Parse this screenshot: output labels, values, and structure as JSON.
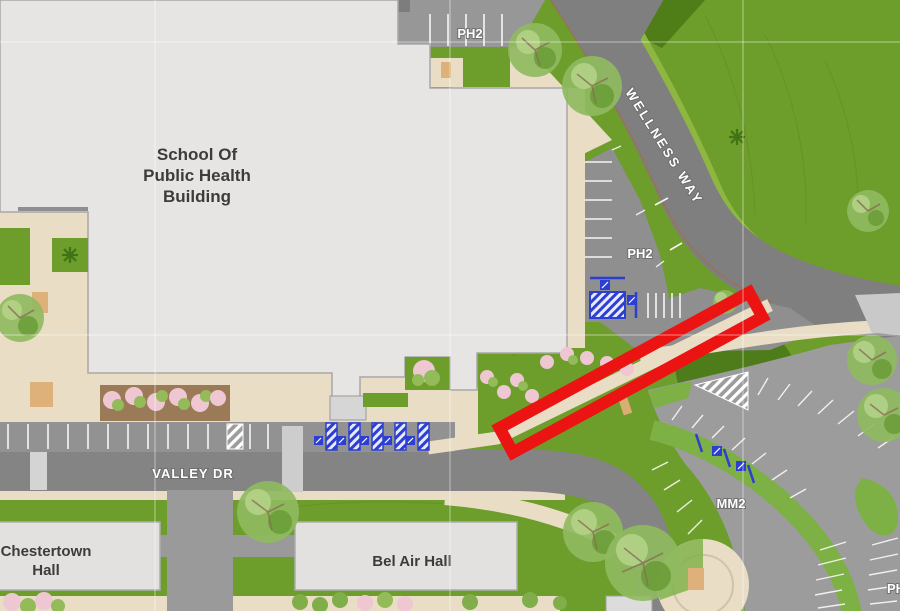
{
  "map": {
    "buildings": {
      "school_of_public_health": {
        "line1": "School Of",
        "line2": "Public Health",
        "line3": "Building"
      },
      "chestertown_hall": {
        "line1": "Chestertown",
        "line2": "Hall"
      },
      "bel_air_hall": {
        "label": "Bel Air Hall"
      }
    },
    "roads": {
      "wellness_way": "WELLNESS WAY",
      "valley_dr": "VALLEY DR"
    },
    "parking_labels": {
      "ph2_north": "PH2",
      "ph2_east": "PH2",
      "mm2": "MM2",
      "ph_partial": "PH"
    },
    "colors": {
      "highlight_red": "#ec1313",
      "accessible_blue": "#2d3fd0",
      "grass_green": "#6d9d2a",
      "road_gray": "#848484",
      "building_gray": "#e6e5e3",
      "path_beige": "#e9ddc6"
    },
    "annotation": {
      "shape": "rotated-rectangle-outline",
      "color": "#ec1313"
    }
  }
}
